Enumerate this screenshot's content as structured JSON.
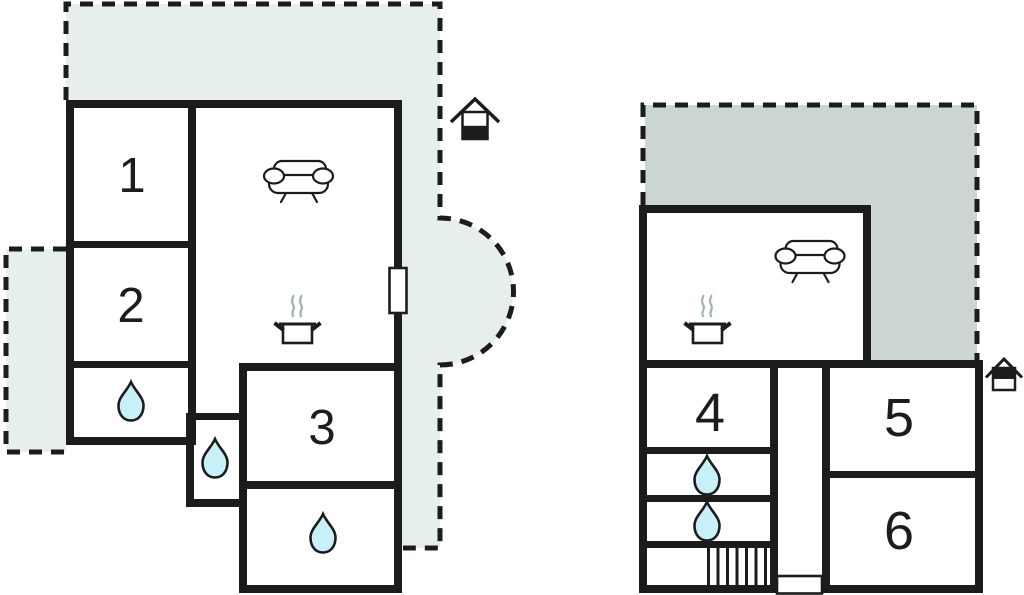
{
  "plan": {
    "type": "floor-plan",
    "left_unit": {
      "room_numbers": [
        "1",
        "2",
        "3"
      ],
      "entrance_level_icon": "house-bottom-half-filled",
      "feature_icons": [
        "sofa",
        "cooking-pot",
        "water-drop",
        "water-drop",
        "water-drop",
        "door",
        "terrace-dashed"
      ]
    },
    "right_unit": {
      "room_numbers": [
        "4",
        "5",
        "6"
      ],
      "entrance_level_icon": "house-top-half-filled",
      "feature_icons": [
        "sofa",
        "cooking-pot",
        "water-drop",
        "water-drop",
        "stairs",
        "door",
        "terrace-dashed"
      ]
    }
  },
  "colors": {
    "wall": "#1c1c1c",
    "terrace_light": "#e7efec",
    "terrace_dark": "#cbd5d3",
    "water": "#c8f0f8",
    "steam": "#a0b4b4",
    "room_fill": "#ffffff"
  }
}
